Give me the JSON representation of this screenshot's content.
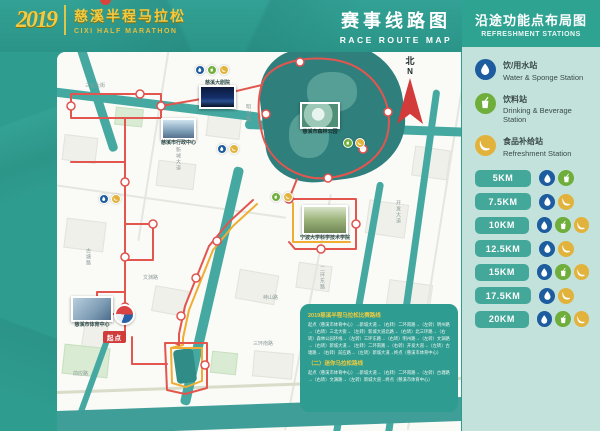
{
  "header": {
    "logo": {
      "year": "2019",
      "title_cn": "慈溪半程马拉松",
      "title_en": "CIXI HALF MARATHON"
    },
    "route_map_title_cn": "赛事线路图",
    "route_map_title_en": "RACE ROUTE MAP"
  },
  "panel": {
    "title_cn": "沿途功能点布局图",
    "title_en": "REFRESHMENT STATIONS",
    "legend": [
      {
        "icon": "water-drop-icon",
        "service": "water",
        "label_cn": "饮/用水站",
        "label_en": "Water & Sponge Station"
      },
      {
        "icon": "drink-cup-icon",
        "service": "cup",
        "label_cn": "饮料站",
        "label_en": "Drinking & Beverage Station"
      },
      {
        "icon": "banana-icon",
        "service": "banana",
        "label_cn": "食品补给站",
        "label_en": "Refreshment Station"
      }
    ],
    "stations": [
      {
        "km": "5KM",
        "services": [
          "water",
          "cup"
        ]
      },
      {
        "km": "7.5KM",
        "services": [
          "water",
          "banana"
        ]
      },
      {
        "km": "10KM",
        "services": [
          "water",
          "cup",
          "banana"
        ]
      },
      {
        "km": "12.5KM",
        "services": [
          "water",
          "banana"
        ]
      },
      {
        "km": "15KM",
        "services": [
          "water",
          "cup",
          "banana"
        ]
      },
      {
        "km": "17.5KM",
        "services": [
          "water",
          "banana"
        ]
      },
      {
        "km": "20KM",
        "services": [
          "water",
          "cup",
          "banana"
        ]
      }
    ]
  },
  "map": {
    "north_cn": "北",
    "north_en": "N",
    "start_badge": "起点",
    "landmarks": [
      {
        "name": "慈溪大剧院"
      },
      {
        "name": "慈溪市行政中心"
      },
      {
        "name": "慈溪市森林公园"
      },
      {
        "name": "宁波大学科学技术学院"
      },
      {
        "name": "慈溪市体育中心"
      }
    ],
    "street_labels": [
      "新城大道",
      "三北大街",
      "明州路",
      "二环东路",
      "开发大道",
      "文渊路",
      "古塘路",
      "三环南路",
      "前应路",
      "峙山路"
    ],
    "info_box": {
      "title1": "2019慈溪半程马拉松比赛路线",
      "body1": "起点（慈溪市体育中心）→新城大道→（右转）二环南路→（左转）明州路→（右转）三北大街→（左转）新城大道北路→（右转）北三环路→（右转）森林公园环线→（左转）三环东路→（右转）明州路→（左转）文渊路→（右转）新城大道→（左转）二环南路→（右转）开发大道→（左转）古塘路→（右转）前应路→（左转）新城大道→终点（慈溪市体育中心）",
      "title2": "（二）迷你马拉松路线",
      "body2": "起点（慈溪市体育中心）→新城大道→（右转）二环南路→（左转）古塘路→（右转）文渊路→（左转）新城大道→终点（慈溪市体育中心）"
    }
  },
  "colors": {
    "header_teal": "#2E9C8F",
    "panel_bg": "#C3E2DC",
    "pill_teal": "#43A89A",
    "water_blue": "#1D5C9E",
    "cup_green": "#6FAE3B",
    "banana_yellow": "#E2B33C",
    "route_red": "#E2564F",
    "route_yellow": "#F0AD33",
    "river_teal": "#46A9A1",
    "park_teal": "#2F7F7D",
    "logo_gold": "#F2CB43"
  }
}
